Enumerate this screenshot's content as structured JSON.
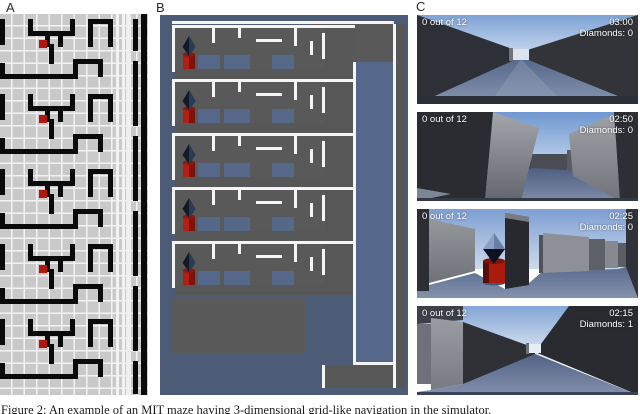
{
  "figure": {
    "caption": "Figure 2: An example of an MIT maze having 3-dimensional grid-like navigation in the simulator.",
    "panels": [
      {
        "label": "A"
      },
      {
        "label": "B"
      },
      {
        "label": "C"
      }
    ]
  },
  "panel_c": {
    "frames": [
      {
        "progress": "0 out of 12",
        "time": "03:00",
        "diamonds": "Diamonds: 0"
      },
      {
        "progress": "0 out of 12",
        "time": "02:50",
        "diamonds": "Diamonds: 0"
      },
      {
        "progress": "0 out of 12",
        "time": "02:25",
        "diamonds": "Diamonds: 0"
      },
      {
        "progress": "0 out of 12",
        "time": "02:15",
        "diamonds": "Diamonds: 1"
      }
    ]
  },
  "colors": {
    "maze_map_bg": "#c9c9c9",
    "maze_map_grid": "#f5f5f5",
    "maze_wall_black": "#0a0a0a",
    "agent_marker_red": "#b21510",
    "render_background_slate": "#4d5c76",
    "render_wall_gray": "#595959",
    "render_floor_blue": "#56688a",
    "render_outline_white": "#f5f5f5",
    "fpv_sky_blue": "#7ea3d6",
    "fpv_floor_slate": "#55668a",
    "fpv_dark_wall": "#2e3037",
    "cylinder_red": "#a91b0f",
    "hud_text": "#ffffff"
  }
}
